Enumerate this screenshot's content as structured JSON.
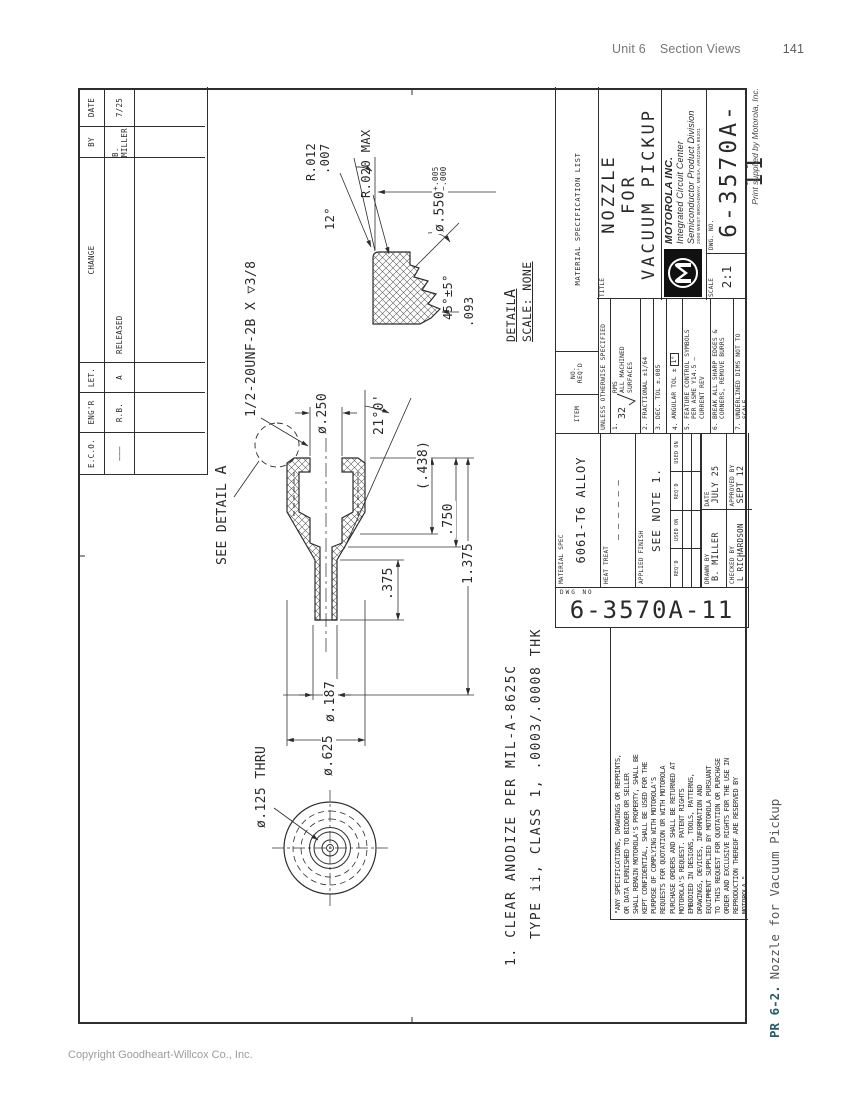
{
  "page": {
    "header_unit": "Unit 6",
    "header_section": "Section Views",
    "header_page": "141",
    "copyright": "Copyright Goodheart-Willcox Co., Inc.",
    "caption_label": "PR 6-2.",
    "caption_text": "Nozzle for Vacuum Pickup",
    "print_credit": "Print supplied by Motorola, Inc.",
    "accent_color": "#255e68"
  },
  "revision_table": {
    "headers": [
      "E.C.O.",
      "ENG'R",
      "LET.",
      "CHANGE",
      "BY",
      "DATE"
    ],
    "row": [
      "———",
      "R.B.",
      "A",
      "RELEASED",
      "B. MILLER",
      "7/25"
    ]
  },
  "material_list_strip": {
    "item": "ITEM",
    "no_reqd": "NO. REQ'D",
    "title": "MATERIAL SPECIFICATION LIST"
  },
  "material_block": {
    "material_spec_label": "MATERIAL SPEC",
    "material_spec": "6061-T6 ALLOY",
    "heat_treat_label": "HEAT TREAT",
    "heat_treat": "– – – – – –",
    "applied_finish_label": "APPLIED FINISH",
    "applied_finish": "SEE NOTE 1.",
    "reqd": "REQ'D",
    "used_on": "USED ON",
    "drawn_by_label": "DRAWN BY",
    "drawn_by": "B. MILLER",
    "date_label": "DATE",
    "date": "JULY 25",
    "checked_by_label": "CHECKED BY",
    "checked_by": "L RICHARDSON",
    "approved_by_label": "APPROVED BY",
    "approved_date": "SEPT 12",
    "dwg_no_label": "DWG NO",
    "dwg_number": "6-3570A-11"
  },
  "tolerances": {
    "header": "UNLESS OTHERWISE SPECIFIED",
    "items": [
      {
        "n": "1.",
        "finish_value": "32",
        "lines": [
          "RMS",
          "ALL MACHINED",
          "SURFACES"
        ]
      },
      {
        "n": "2.",
        "lines": [
          "FRACTIONAL   ±1/64"
        ]
      },
      {
        "n": "3.",
        "lines": [
          "DEC. TOL   ±.005"
        ]
      },
      {
        "n": "4.",
        "lines": [
          "ANGULAR TOL ±"
        ],
        "boxed": "1°"
      },
      {
        "n": "5.",
        "lines": [
          "FEATURE CONTROL SYMBOLS",
          "PER ASME Y14.5 —",
          "CURRENT REV"
        ]
      },
      {
        "n": "6.",
        "lines": [
          "BREAK ALL SHARP EDGES &",
          "CORNERS, REMOVE BURRS"
        ]
      },
      {
        "n": "7.",
        "lines": [
          "UNDERLINED DIMS NOT TO",
          "SCALE"
        ]
      }
    ]
  },
  "title_block": {
    "title_label": "TITLE",
    "title_lines": [
      "NOZZLE",
      "FOR",
      "VACUUM PICKUP"
    ],
    "company": "MOTOROLA INC.",
    "division1": "Integrated  Circuit  Center",
    "division2": "Semiconductor Product Division",
    "address": "2000 WEST BROADWAY, MESA, ARIZONA 85201",
    "scale_label": "SCALE",
    "scale_value": "2:1",
    "dwg_label": "DWG. NO.",
    "dwg_number": "6-3570A-11"
  },
  "legal_text": "\"ANY SPECIFICATIONS, DRAWINGS OR REPRINTS,\nOR DATA FURNISHED TO BIDDER OR SELLER\nSHALL REMAIN MOTOROLA'S PROPERTY, SHALL BE\nKEPT CONFIDENTIAL, SHALL BE USED FOR THE\nPURPOSE OF COMPLYING WITH MOTOROLA'S\nREQUESTS FOR QUOTATION OR WITH MOTOROLA\nPURCHASE ORDERS AND SHALL BE RETURNED AT\nMOTOROLA'S REQUEST.  PATENT RIGHTS\nEMBODIED IN DESIGNS, TOOLS, PATTERNS,\nDRAWINGS, DEVICES, INFORMATION AND\nEQUIPMENT SUPPLIED BY MOTOROLA PURSUANT\nTO THIS REQUEST FOR QUOTATION OR PURCHASE\nORDER AND EXCLUSIVE RIGHTS FOR THE USE IN\nREPRODUCTION THEREOF ARE  RESERVED  BY\nMOTOROLA.\"",
  "notes": {
    "line1": "1.  CLEAR ANODIZE PER MIL-A-8625C",
    "line2": "TYPE ii, CLASS 1, .0003/.0008 THK"
  },
  "dims": {
    "thread_callout": "1/2-20UNF-2B X ▽3/8",
    "see_detail": "SEE DETAIL",
    "see_detail_a": "A",
    "d250": "ø.250",
    "taper_angle": "21°0'",
    "ref438": "(.438)",
    "len750": ".750",
    "len1375": "1.375",
    "len375": ".375",
    "d625": "ø.625",
    "d187": "ø.187",
    "d125": "ø.125 THRU",
    "r012": "R.012",
    "r012b": ".007",
    "angle12": "12°",
    "d550": "ø.550",
    "d550_plus": "+.005",
    "d550_minus": "−.000",
    "r020": "R.020 MAX",
    "chamfer": "45°±5°",
    "groove": ".093",
    "detail_label": "DETAIL",
    "detail_a": "A",
    "detail_scale": "SCALE: NONE"
  }
}
